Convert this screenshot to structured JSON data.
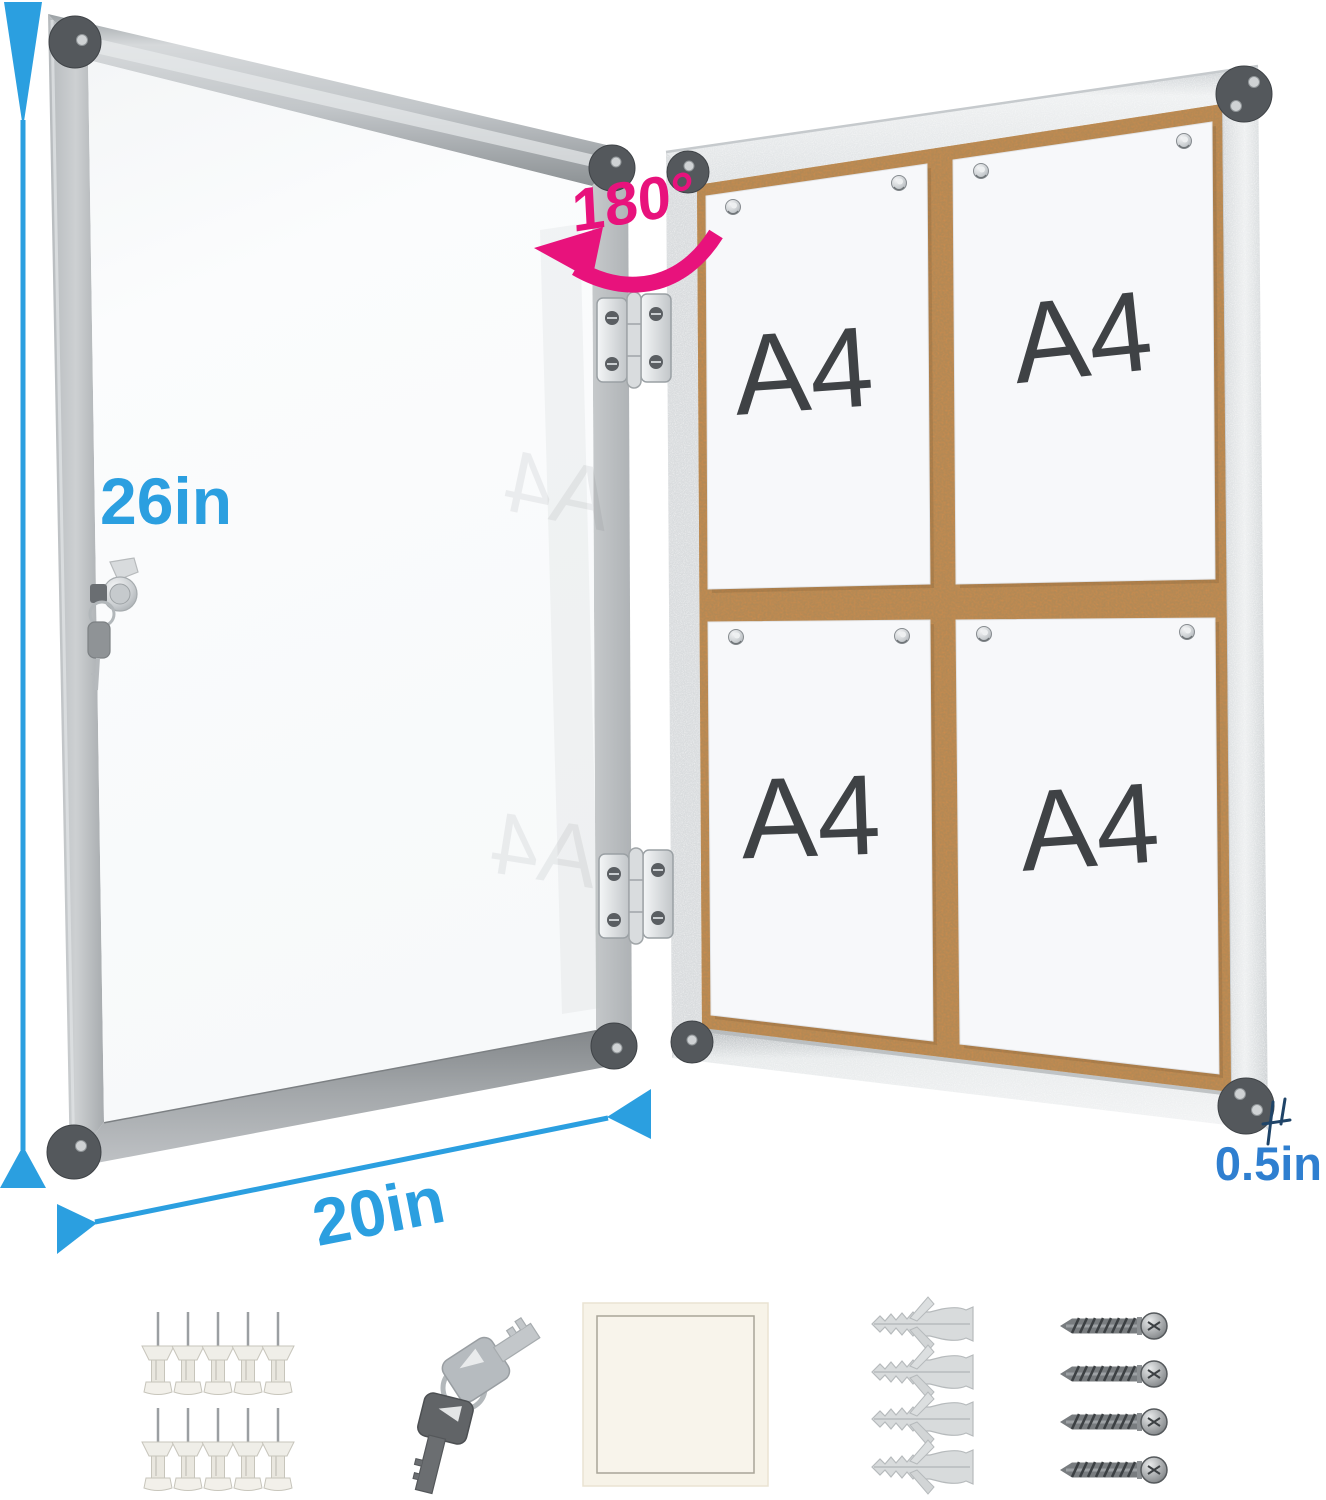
{
  "annotations": {
    "height": "26in",
    "width": "20in",
    "depth": "0.5in",
    "rotation": "180°"
  },
  "papers": [
    {
      "label": "A4"
    },
    {
      "label": "A4"
    },
    {
      "label": "A4"
    },
    {
      "label": "A4"
    }
  ],
  "colors": {
    "dimension_blue": "#2b9fe0",
    "depth_blue": "#2f7fd0",
    "rotation_magenta": "#e8127c",
    "cork_brown": "#ca8c4f",
    "door_frame_gray": "#b9bdc0",
    "board_frame_silver": "#eef0f1",
    "paper_white": "#f7f8fa",
    "a4_text": "#3f4245"
  },
  "accessories": {
    "push_pins_count": 10,
    "keys_count": 2,
    "adhesive_pads_count": 1,
    "wall_anchors_count": 4,
    "screws_count": 4
  }
}
